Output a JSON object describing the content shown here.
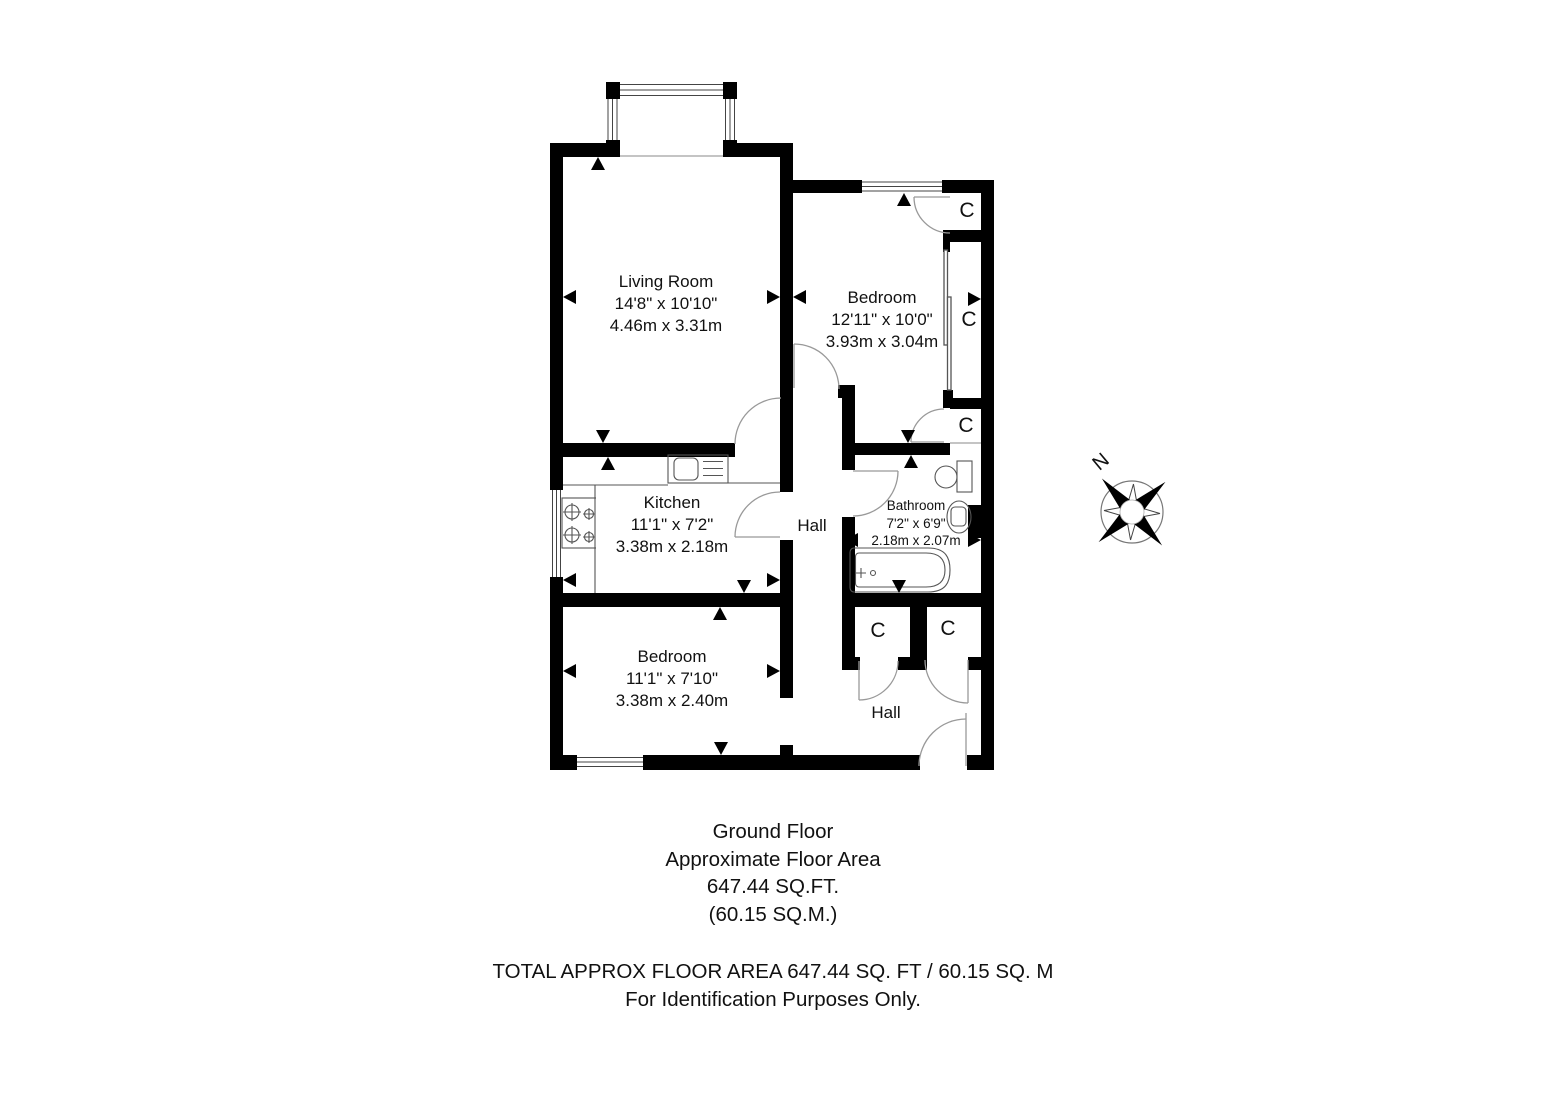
{
  "rooms": {
    "living_room": {
      "name": "Living Room",
      "imperial": "14'8\" x 10'10\"",
      "metric": "4.46m x 3.31m"
    },
    "bedroom1": {
      "name": "Bedroom",
      "imperial": "12'11\" x 10'0\"",
      "metric": "3.93m x 3.04m"
    },
    "kitchen": {
      "name": "Kitchen",
      "imperial": "11'1\" x 7'2\"",
      "metric": "3.38m x 2.18m"
    },
    "bathroom": {
      "name": "Bathroom",
      "imperial": "7'2\" x 6'9\"",
      "metric": "2.18m x 2.07m"
    },
    "bedroom2": {
      "name": "Bedroom",
      "imperial": "11'1\" x 7'10\"",
      "metric": "3.38m x 2.40m"
    },
    "hall_center": {
      "name": "Hall"
    },
    "hall_lower": {
      "name": "Hall"
    },
    "closet_label": "C"
  },
  "compass": {
    "north_label": "N"
  },
  "title_block": {
    "floor_name": "Ground Floor",
    "area_label": "Approximate Floor Area",
    "area_sqft": "647.44 SQ.FT.",
    "area_sqm": "(60.15 SQ.M.)"
  },
  "footer": {
    "total_line": "TOTAL APPROX FLOOR AREA 647.44 SQ. FT / 60.15 SQ. M",
    "disclaimer": "For Identification Purposes Only."
  }
}
